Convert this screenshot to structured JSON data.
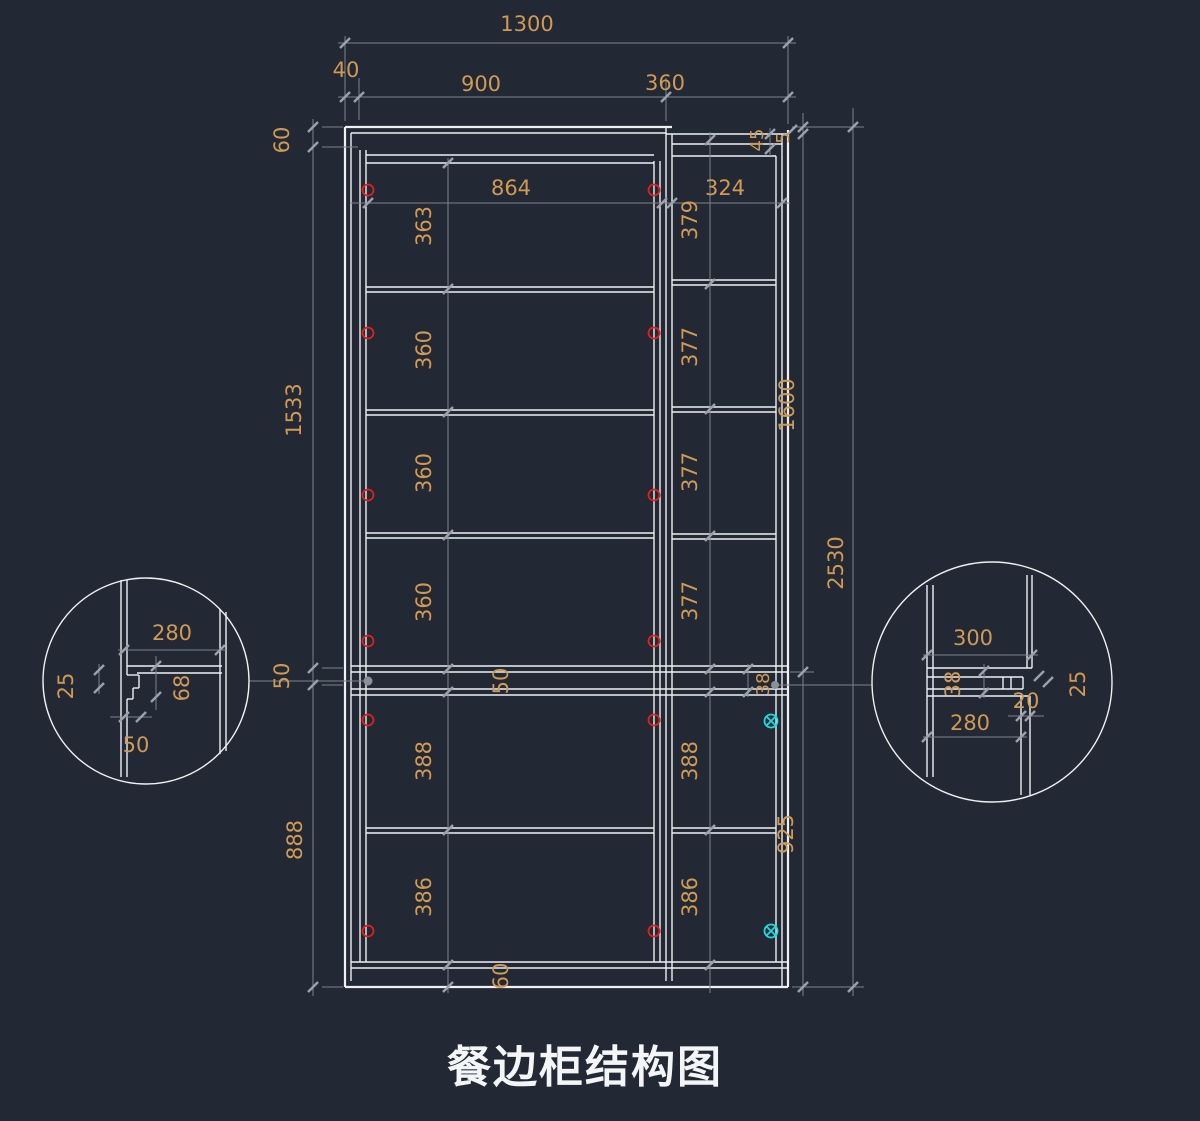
{
  "title": "餐边柜结构图",
  "colors": {
    "background": "#222834",
    "structure_line": "#eef0f2",
    "dimension_line": "#7d838d",
    "dimension_text": "#cf9a55",
    "connector_marker": "#e0201a",
    "fitting_marker": "#1adce0"
  },
  "top_dims": {
    "overall": "1300",
    "left": "40",
    "middle": "900",
    "right": "360"
  },
  "left_dims": {
    "top": "60",
    "upper": "1533",
    "middle": "50",
    "lower": "888"
  },
  "right_dims": {
    "top_rail": "45",
    "top_gap": "5",
    "upper": "1600",
    "lower": "925",
    "overall": "2530"
  },
  "main_section": {
    "width": "864",
    "row_heights": [
      "363",
      "360",
      "360",
      "360"
    ],
    "middle_band": "50",
    "lower_heights": [
      "388",
      "386"
    ],
    "base_height": "60"
  },
  "side_section": {
    "width": "324",
    "row_heights": [
      "379",
      "377",
      "377",
      "377"
    ],
    "middle_band": "38",
    "lower_heights": [
      "388",
      "386"
    ]
  },
  "detail_left": {
    "width": "280",
    "panel_thickness": "25",
    "notch_height": "68",
    "notch_width": "50"
  },
  "detail_right": {
    "top_width": "300",
    "band_height": "38",
    "bottom_width": "280",
    "step_width": "20",
    "panel_thickness": "25"
  }
}
